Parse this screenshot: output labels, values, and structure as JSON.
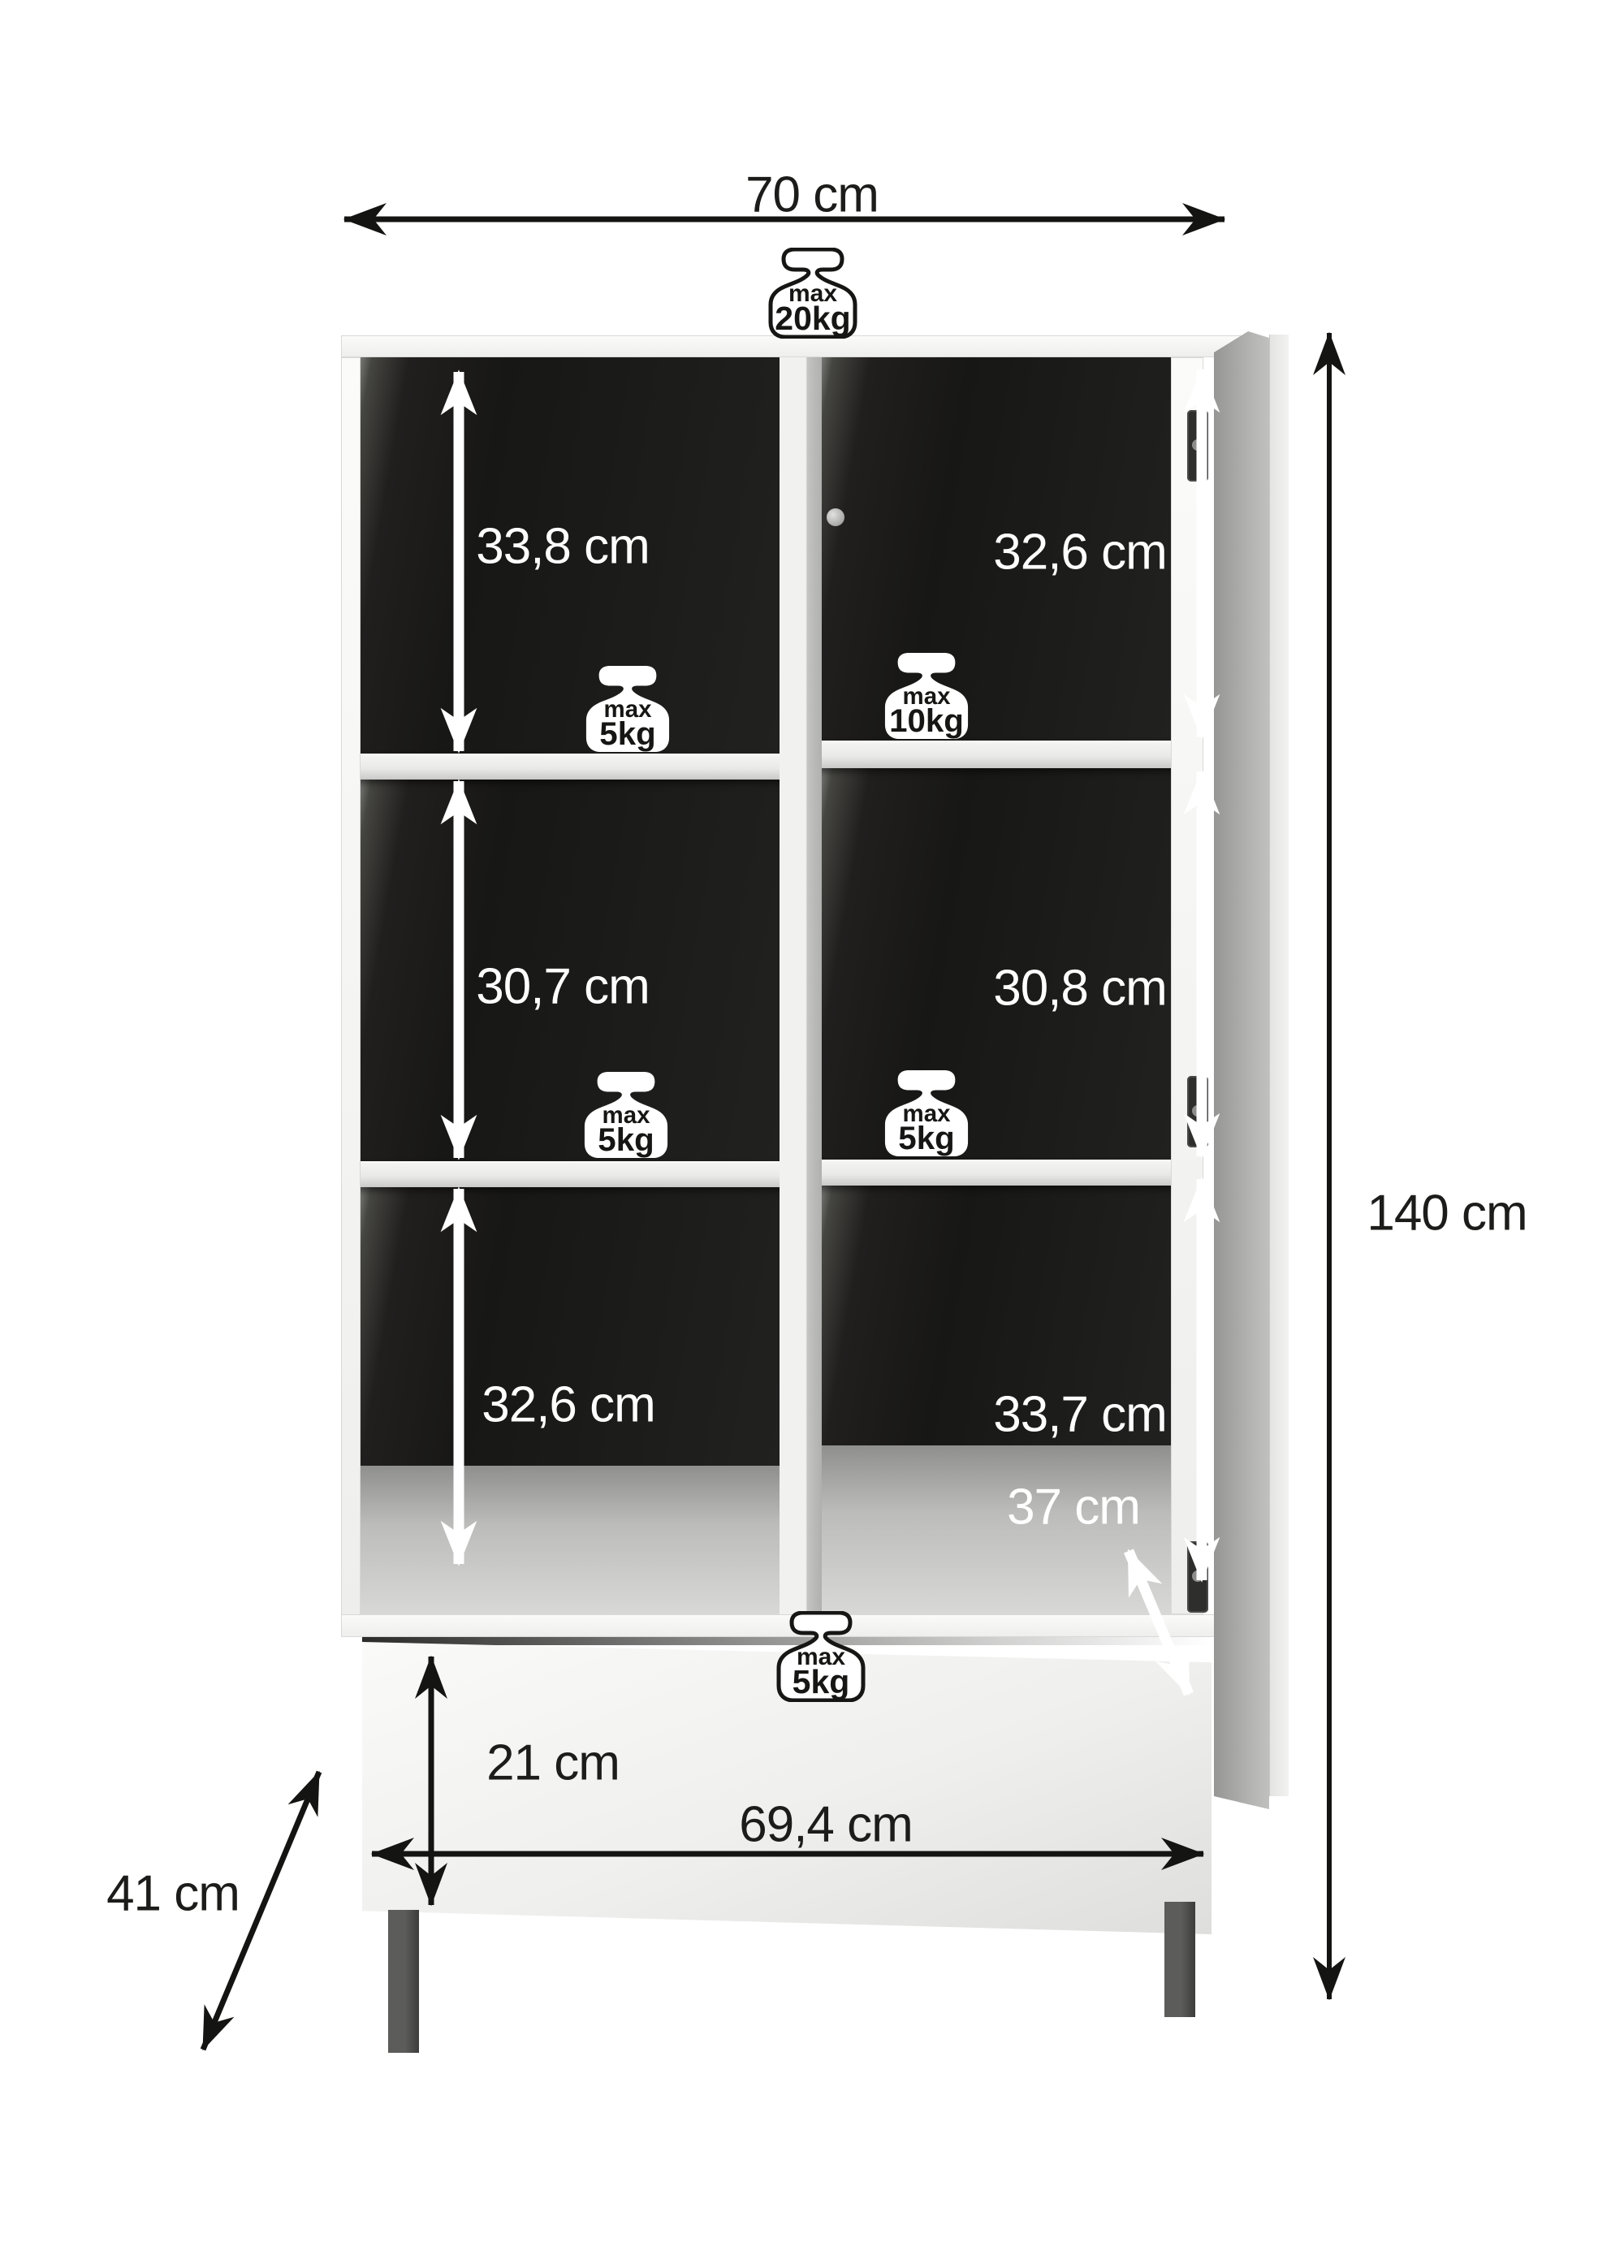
{
  "page": {
    "title": "Cabinet dimension diagram",
    "background": "#ffffff"
  },
  "dimensions": {
    "width_top": "70 cm",
    "height_total": "140 cm",
    "drawer_height": "21 cm",
    "drawer_width": "69,4 cm",
    "depth_total": "41 cm",
    "shelf_depth": "37 cm"
  },
  "compartments": [
    {
      "id": "top-left",
      "height": "33,8 cm",
      "load_line1": "max",
      "load_line2": "5kg"
    },
    {
      "id": "top-right",
      "height": "32,6 cm",
      "load_line1": "max",
      "load_line2": "10kg"
    },
    {
      "id": "middle-left",
      "height": "30,7 cm",
      "load_line1": "max",
      "load_line2": "5kg"
    },
    {
      "id": "middle-right",
      "height": "30,8 cm",
      "load_line1": "max",
      "load_line2": "5kg"
    },
    {
      "id": "bottom-left",
      "height": "32,6 cm"
    },
    {
      "id": "bottom-right",
      "height": "33,7 cm"
    }
  ],
  "loads": {
    "top": {
      "line1": "max",
      "line2": "20kg"
    },
    "drawer": {
      "line1": "max",
      "line2": "5kg"
    }
  },
  "colors": {
    "interior_black": "#1b1b19",
    "panel_white": "#f2f2f0",
    "door_grey": "#b0b0ae",
    "leg_grey": "#4c4c4a",
    "arrow_black": "#141412",
    "arrow_white": "#ffffff"
  }
}
